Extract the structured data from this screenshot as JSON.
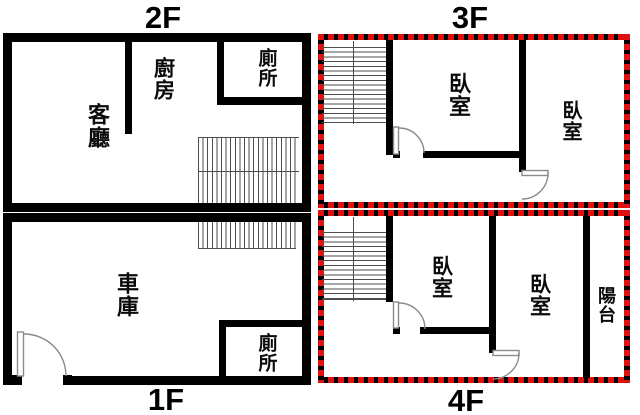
{
  "colors": {
    "wall": "#000000",
    "background": "#ffffff",
    "highlight_dash_red": "#e01111",
    "stair_line": "#4d4d4d",
    "door_line": "#8a8a8a"
  },
  "floors": {
    "f1": {
      "label": "1F",
      "rooms": {
        "garage": "車庫",
        "toilet": "廁所"
      }
    },
    "f2": {
      "label": "2F",
      "rooms": {
        "living": "客廳",
        "kitchen": "廚房",
        "toilet": "廁所"
      }
    },
    "f3": {
      "label": "3F",
      "rooms": {
        "bedroom1": "臥室",
        "bedroom2": "臥室"
      }
    },
    "f4": {
      "label": "4F",
      "rooms": {
        "bedroom1": "臥室",
        "bedroom2": "臥室",
        "balcony": "陽台"
      }
    }
  }
}
